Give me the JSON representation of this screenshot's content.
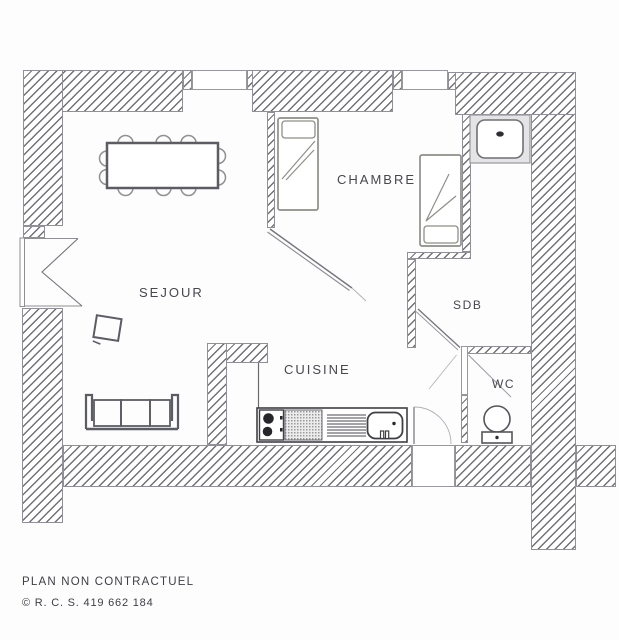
{
  "plan": {
    "rooms": {
      "sejour": {
        "label": "SEJOUR"
      },
      "chambre": {
        "label": "CHAMBRE"
      },
      "cuisine": {
        "label": "CUISINE"
      },
      "sdb": {
        "label": "SDB"
      },
      "wc": {
        "label": "WC"
      }
    },
    "footer": {
      "line1": "PLAN NON CONTRACTUEL",
      "line2": "© R. C. S. 419 662 184"
    },
    "colors": {
      "hatch_line": "#58585e",
      "wall_outline": "#90909a",
      "furniture_dark": "#5c5c64",
      "furniture_light": "#8f8f88",
      "counter_dark": "#3f3f45",
      "text": "#47474f"
    }
  }
}
